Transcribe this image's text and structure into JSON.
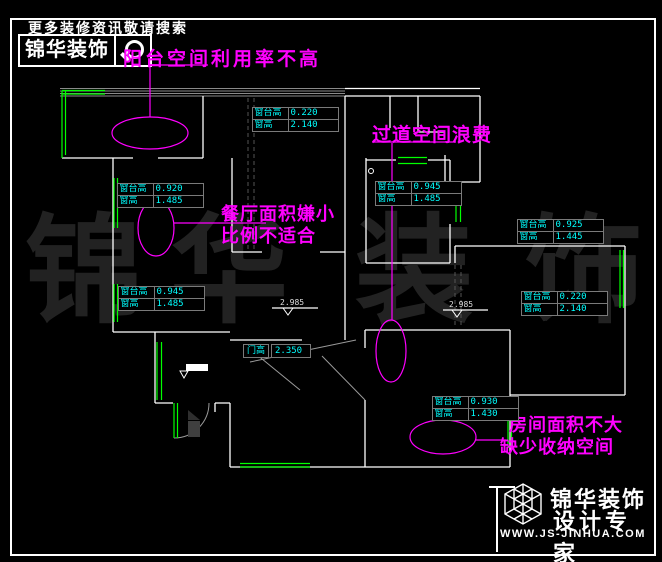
{
  "header": {
    "slogan": "更多装修资讯敬请搜索",
    "brand": "锦华装饰"
  },
  "annotations": {
    "balcony": "阳台空间利用率不高",
    "corridor": "过道空间浪费",
    "dining_line1": "餐厅面积嫌小",
    "dining_line2": "比例不适合",
    "bedroom_line1": "房间面积不大",
    "bedroom_line2": "缺少收纳空间"
  },
  "tables": [
    {
      "r1_label": "窗台高",
      "r1_value": "0.220",
      "r2_label": "窗高",
      "r2_value": "2.140"
    },
    {
      "r1_label": "窗台高",
      "r1_value": "0.920",
      "r2_label": "窗高",
      "r2_value": "1.485"
    },
    {
      "r1_label": "窗台高",
      "r1_value": "0.945",
      "r2_label": "窗高",
      "r2_value": "1.485"
    },
    {
      "r1_label": "窗台高",
      "r1_value": "0.925",
      "r2_label": "窗高",
      "r2_value": "1.445"
    },
    {
      "r1_label": "窗台高",
      "r1_value": "0.945",
      "r2_label": "窗高",
      "r2_value": "1.485"
    },
    {
      "r1_label": "窗台高",
      "r1_value": "0.220",
      "r2_label": "窗高",
      "r2_value": "2.140"
    },
    {
      "r1_label": "窗台高",
      "r1_value": "0.930",
      "r2_label": "窗高",
      "r2_value": "1.430"
    }
  ],
  "door_table": {
    "label": "门高",
    "value": "2.350"
  },
  "level_marks": {
    "mark1": "2.985",
    "mark2": "2.985"
  },
  "watermark": {
    "char1": "锦",
    "char2": "华",
    "char3": "装",
    "char4": "饰"
  },
  "footer": {
    "brand_line1": "锦华装饰",
    "brand_line2": "设计专家",
    "website": "WWW.JS-JINHUA.COM"
  },
  "colors": {
    "background": "#000000",
    "wall": "#ffffff",
    "window": "#00ff00",
    "dimension_text": "#00ffff",
    "annotation": "#ff00ff",
    "table_border": "#7a7a7a",
    "watermark": "#222222"
  }
}
